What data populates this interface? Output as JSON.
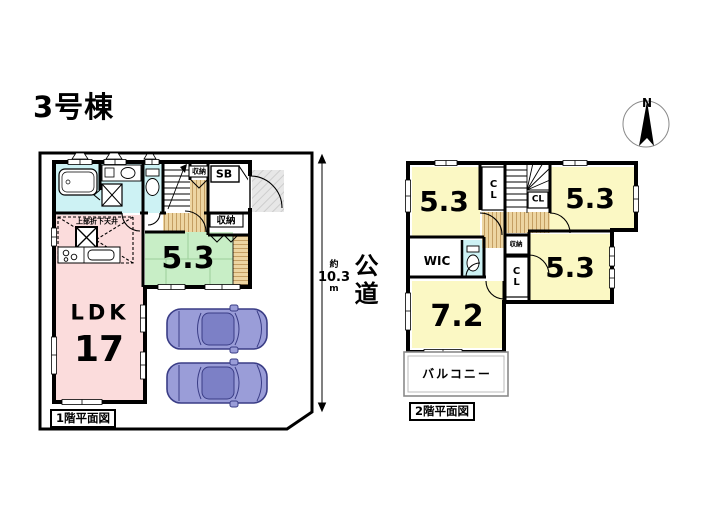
{
  "title": "3号棟",
  "compass": {
    "north": "N"
  },
  "road": {
    "label": "公道",
    "approx": "約",
    "value": "10.3",
    "unit": "m"
  },
  "floor1": {
    "caption": "1階平面図",
    "ldk_label": "LDK",
    "ldk_size": "17",
    "room_size": "5.3",
    "stair_closet": "収納",
    "shoe_box": "SB",
    "storage": "収納",
    "kitchen_note": "上部折下天井"
  },
  "floor2": {
    "caption": "2階平面図",
    "room_nw_size": "5.3",
    "room_ne_size": "5.3",
    "room_e_size": "5.3",
    "room_sw_size": "7.2",
    "wic": "WIC",
    "cl_nw": "CL",
    "cl_mid": "CL",
    "cl_e": "CL",
    "storage": "収納",
    "balcony": "バルコニー"
  },
  "colors": {
    "ldk_fill": "#fbdcdc",
    "tatami_fill": "#c8eec6",
    "bedroom_fill": "#fbf8c4",
    "wet_area_fill": "#cdf2f4",
    "wood_fill": "#edd5a2",
    "car_fill": "#9a9dd8",
    "wall": "#000000"
  }
}
